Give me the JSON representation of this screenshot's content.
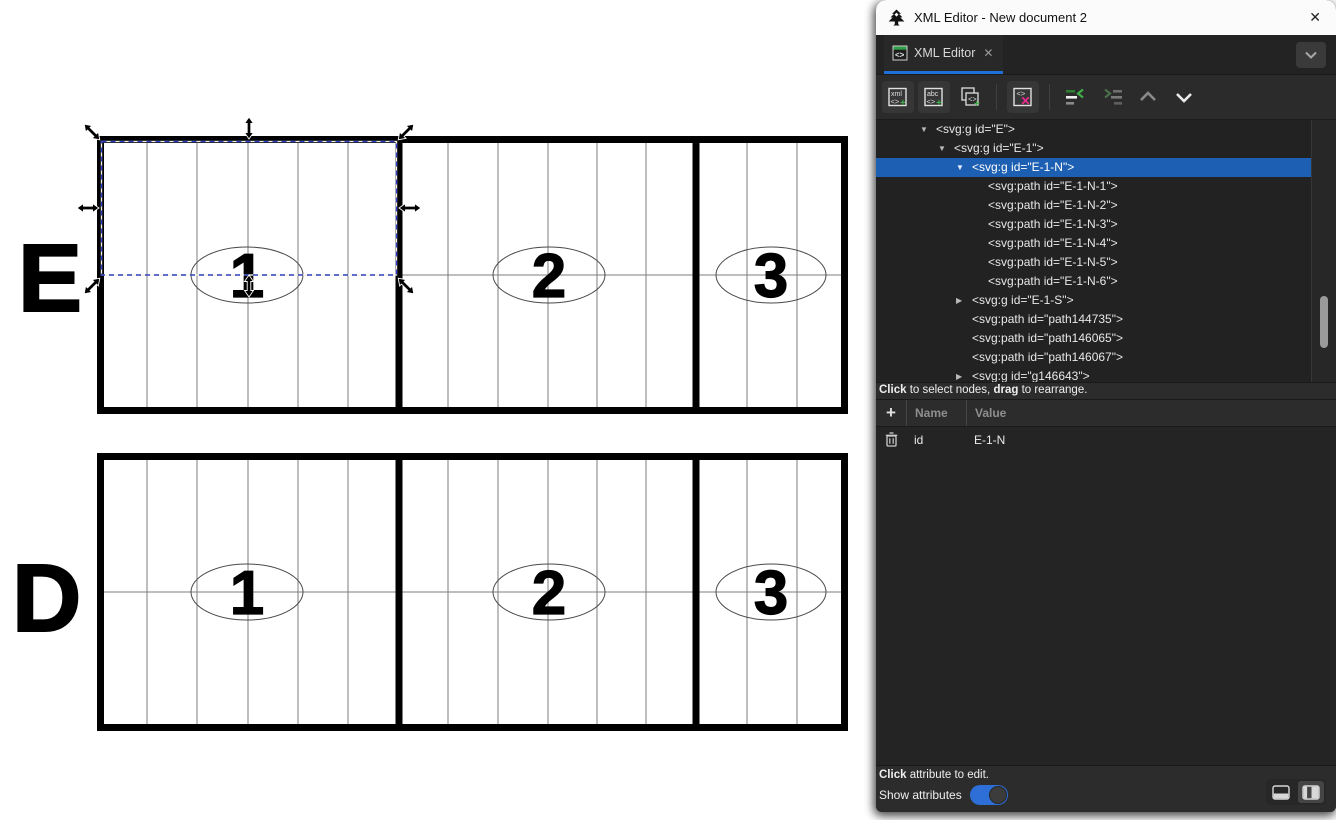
{
  "canvas": {
    "rows": [
      {
        "label": "E",
        "sections": [
          "1",
          "2",
          "3"
        ]
      },
      {
        "label": "D",
        "sections": [
          "1",
          "2",
          "3"
        ]
      }
    ]
  },
  "panel": {
    "title": "XML Editor - New document 2",
    "close_glyph": "✕",
    "tab": {
      "label": "XML Editor",
      "close_glyph": "✕"
    },
    "icons": {
      "xml_text": "xml",
      "abc_text": "abc",
      "tag_text": "<>",
      "plus_text": "+",
      "delete_cross": "✕"
    },
    "colors": {
      "selection_blue": "#1d5fb2",
      "tab_underline_blue": "#1f6fd8",
      "toggle_blue": "#2d6fd6",
      "new_node_green": "#3fae49",
      "delete_pink": "#ef2a90"
    },
    "tree": {
      "rows": [
        {
          "caret": "▼",
          "label": "<svg:g id=\"E\">"
        },
        {
          "caret": "▼",
          "label": "<svg:g id=\"E-1\">"
        },
        {
          "caret": "▼",
          "label": "<svg:g id=\"E-1-N\">"
        },
        {
          "caret": "",
          "label": "<svg:path id=\"E-1-N-1\">"
        },
        {
          "caret": "",
          "label": "<svg:path id=\"E-1-N-2\">"
        },
        {
          "caret": "",
          "label": "<svg:path id=\"E-1-N-3\">"
        },
        {
          "caret": "",
          "label": "<svg:path id=\"E-1-N-4\">"
        },
        {
          "caret": "",
          "label": "<svg:path id=\"E-1-N-5\">"
        },
        {
          "caret": "",
          "label": "<svg:path id=\"E-1-N-6\">"
        },
        {
          "caret": "▶",
          "label": "<svg:g id=\"E-1-S\">"
        },
        {
          "caret": "",
          "label": "<svg:path id=\"path144735\">"
        },
        {
          "caret": "",
          "label": "<svg:path id=\"path146065\">"
        },
        {
          "caret": "",
          "label": "<svg:path id=\"path146067\">"
        },
        {
          "caret": "▶",
          "label": "<svg:g id=\"g146643\">"
        }
      ],
      "hint": {
        "b1": "Click",
        "t1": " to select nodes, ",
        "b2": "drag",
        "t2": " to rearrange."
      }
    },
    "attributes": {
      "add_glyph": "+",
      "name_header": "Name",
      "value_header": "Value",
      "rows": [
        {
          "name": "id",
          "value": "E-1-N"
        }
      ]
    },
    "footer": {
      "hint_b": "Click",
      "hint_t": " attribute to edit.",
      "toggle_label": "Show attributes",
      "toggle_on": true
    }
  }
}
